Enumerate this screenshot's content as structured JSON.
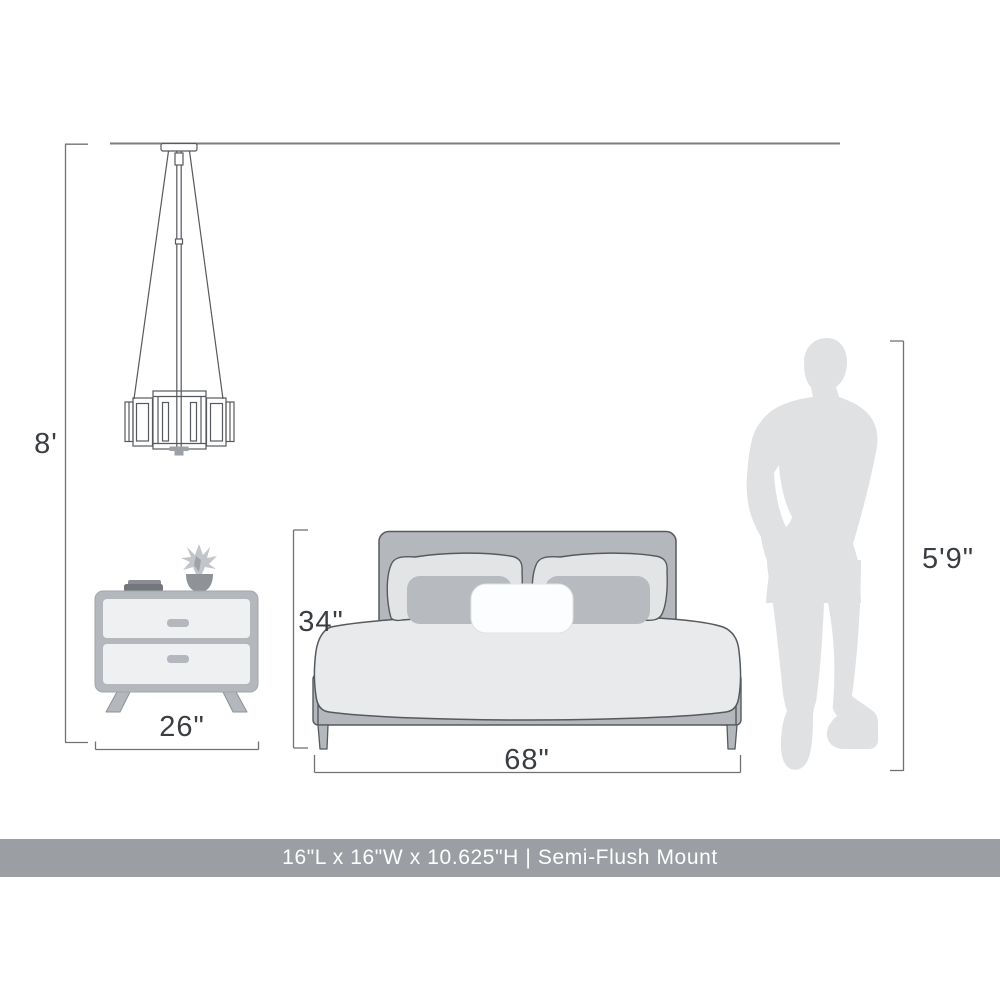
{
  "diagram": {
    "labels": {
      "ceiling_height": "8'",
      "nightstand_width": "26\"",
      "bed_height": "34\"",
      "bed_width": "68\"",
      "person_height": "5'9\""
    },
    "colors": {
      "furniture_gray": "#b4b7bc",
      "pillow_light_gray": "#e3e4e6",
      "duvet_gray": "#e9eaeb",
      "person_silhouette_gray": "#e0e1e3",
      "outline_gray": "#56595d",
      "dimension_line_gray": "#6f7275",
      "label_text": "#3a3d41",
      "banner_gray": "#9b9ea2"
    }
  },
  "banner": {
    "text": "16\"L x 16\"W x 10.625\"H | Semi-Flush Mount",
    "background": "#9b9ea2",
    "text_color": "#ffffff"
  }
}
